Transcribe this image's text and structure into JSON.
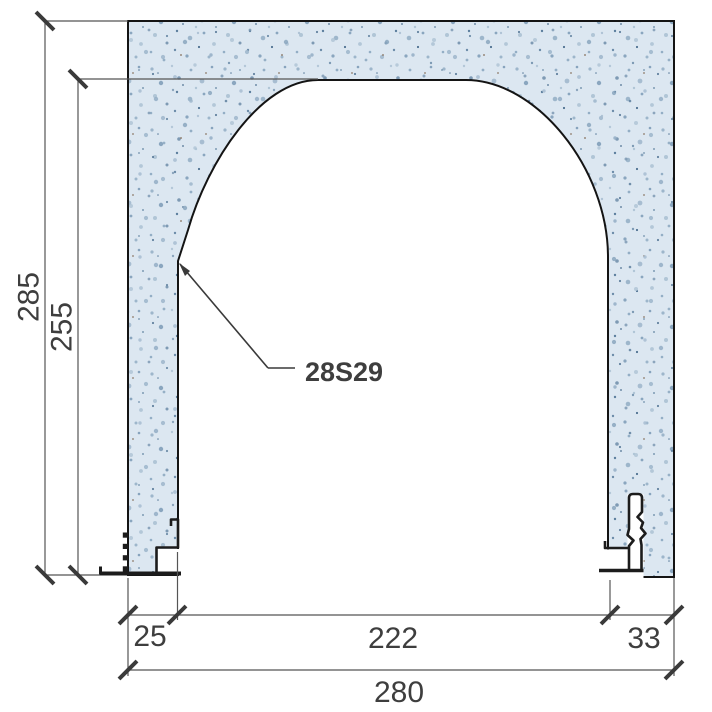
{
  "drawing": {
    "type": "construction-section-detail",
    "annotation": {
      "profile_code": "28S29"
    },
    "dimensions": {
      "total_height": "285",
      "opening_height": "255",
      "left_jamb_width": "25",
      "opening_width": "222",
      "right_jamb_width": "33",
      "total_width": "280"
    },
    "colors": {
      "background": "#ffffff",
      "concrete_base": "#dce7f1",
      "concrete_outline": "#141414",
      "dimension_line": "#555555",
      "tick": "#3a3a3a",
      "label_text": "#3e3e3e",
      "profile": "#1c1c1c"
    }
  }
}
